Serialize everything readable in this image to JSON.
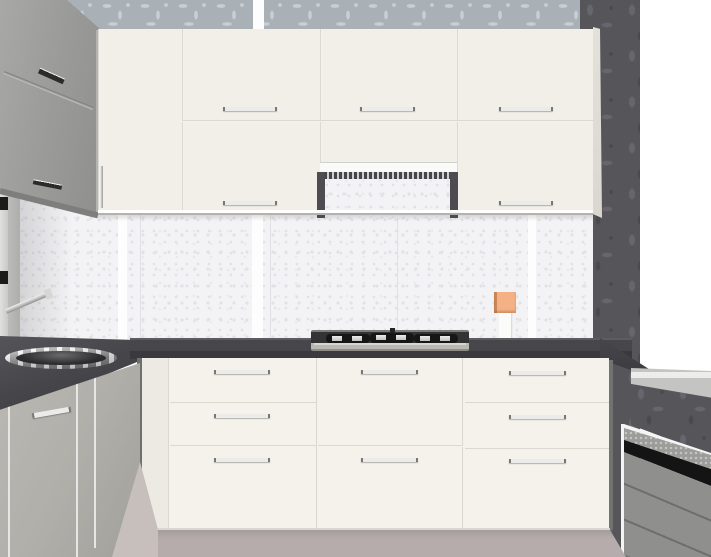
{
  "scene": {
    "type": "3d-kitchen-render",
    "description": "Corner kitchen viewport: cream flat-front cabinets, dark gray worktop, gas hob with cooker hood, round stainless sink on left run, damask wallpaper back wall, dark damask right wall with radiator and stainless shelf",
    "walls": {
      "back_wall": "light gray-blue floral damask wallpaper band",
      "right_wall": "dark gray damask wallpaper",
      "splashback": "white speckled stone panels with bright joint strips",
      "open_corner": "white unrendered void at top right"
    },
    "objects": {
      "corner_wall_cabinet": {
        "finish": "gray",
        "doors": 2,
        "handles": 2
      },
      "upper_cabinets": {
        "finish": "cream",
        "doors": 6,
        "handles": 5
      },
      "cooker_hood": {
        "style": "slim pull-out",
        "vent": "slotted grille"
      },
      "gas_hob": {
        "burners": 3,
        "material": "stainless steel"
      },
      "sink": {
        "shape": "round",
        "material": "stainless steel",
        "faucet": "wall-angled chrome"
      },
      "base_units_front": {
        "finish": "cream",
        "drawer_fronts": 8,
        "handles": 8
      },
      "base_units_left": {
        "finish": "gray",
        "doors": 3,
        "handles": 1
      },
      "worktop": {
        "finish": "dark gray stone"
      },
      "right_shelf": {
        "material": "stainless edge"
      },
      "radiator": {
        "style": "slatted panel with perforated top"
      },
      "decor_item": {
        "name": "orange canister on stand",
        "position": "on splashback shelf"
      }
    },
    "floor": "mauve-gray tiles"
  },
  "colors": {
    "void": "#ffffff",
    "wallpaper-base": "#a9b1b7",
    "wallpaper-pattern": "#c7cfd3",
    "dark-wall": "#56565a",
    "dark-wall-pattern": "#66666d",
    "dark-wall-pattern2": "#494950",
    "backsplash": "#f3f3f5",
    "backsplash-speckle": "#e2e2e6",
    "tile-joint": "#fdfdfd",
    "tile-line": "#e1e1e5",
    "upper-front": "#f1efe8",
    "door-gap": "#cdcbc3",
    "cab-bottom-dark": "#b4b2ae",
    "gray-cab": "#9c9c9a",
    "gray-cab-dark": "#7e7e7c",
    "gray-cab-light": "#b3b3b1",
    "side-sliver": "#d9d7cf",
    "counter-top": "#47474b",
    "counter-front": "#3a3a3e",
    "counter-highlight": "#5d5d61",
    "base-front": "#f4f2eb",
    "base-side": "#eceae2",
    "left-base": "#b1afaa",
    "left-base-dark": "#a2a09b",
    "handle-chrome": "#ebebe9",
    "handle-end": "#77777a",
    "handle-dark": "#2b2b2b",
    "hood-white": "#fafaf8",
    "hood-vent": "#46464a",
    "hood-rail": "#4d4d51",
    "cooktop-dark": "#333335",
    "cooktop-steel": "#bab8b3",
    "burner-black": "#161616",
    "burner-cap": "#c2c2c0",
    "sink-chrome-light": "#fdfdfd",
    "sink-chrome-dark": "#8a8a8a",
    "sink-basin": "#2f2f31",
    "faucet-chrome": "#d6d6d4",
    "orange-item": "#f3b185",
    "orange-shade": "#c8885c",
    "item-stand": "#fbfbf9",
    "right-counter": "#c4c4c2",
    "right-counter-edge": "#ededeb",
    "rad-top": "#9c9c9a",
    "rad-dot": "#c6c6c4",
    "rad-black": "#141414",
    "rad-face": "#8f8f8d",
    "rad-groove": "#6e6e6c",
    "rad-edge": "#f4f4f2",
    "floor": "#b6acac",
    "floor-wedge": "#c7bfbc",
    "hinge-black": "#1b1b1b",
    "left-panel": "#e0e0de",
    "left-panel2": "#bcbcba"
  }
}
